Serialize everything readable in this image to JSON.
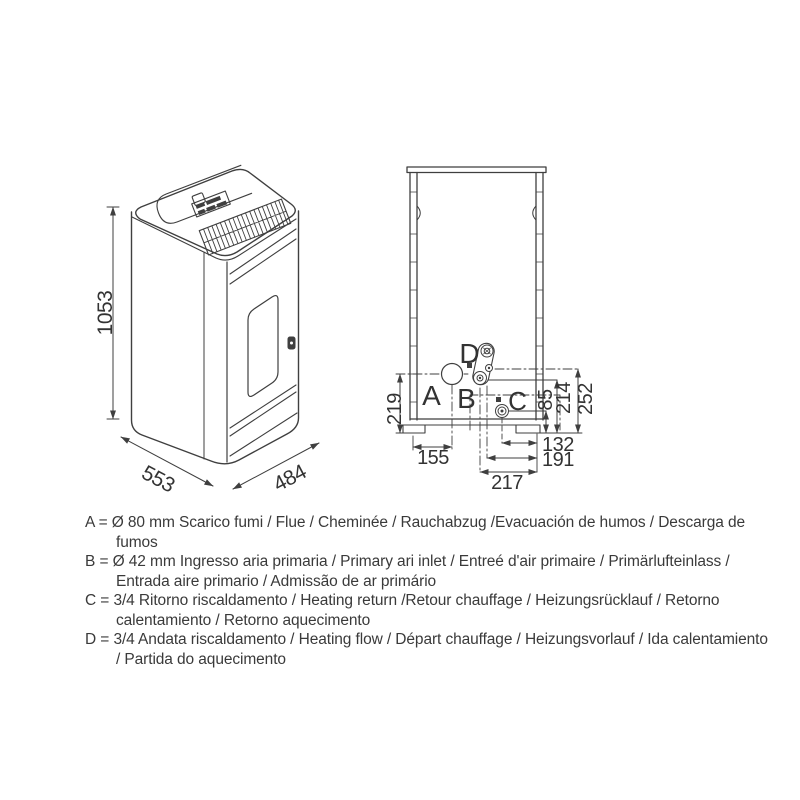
{
  "page": {
    "background": "#ffffff",
    "line_color": "#3f3f3f"
  },
  "iso_view": {
    "description": "isometric-stove-drawing",
    "dims": {
      "height": "1053",
      "depth": "553",
      "width": "484"
    }
  },
  "rear_view": {
    "description": "rear-connections-drawing",
    "labels": {
      "a": "A",
      "b": "B",
      "c": "C",
      "d": "D"
    },
    "dims": {
      "d219": "219",
      "d155": "155",
      "d85": "85",
      "d214": "214",
      "d252": "252",
      "d132": "132",
      "d191": "191",
      "d217": "217"
    }
  },
  "legend": {
    "items": [
      {
        "text": "A = Ø 80 mm Scarico fumi / Flue / Cheminée / Rauchabzug /Evacuación de humos / Descarga de fumos"
      },
      {
        "text": "B = Ø 42 mm Ingresso aria primaria / Primary ari inlet / Entreé d'air primaire / Primärlufteinlass / Entrada aire primario / Admissão de ar primário"
      },
      {
        "text": "C = 3/4  Ritorno riscaldamento / Heating return /Retour chauffage / Heizungsrücklauf / Retorno calentamiento / Retorno aquecimento"
      },
      {
        "text": "D = 3/4 Andata riscaldamento / Heating flow / Départ chauffage / Heizungsvorlauf / Ida calentamiento / Partida do aquecimento"
      }
    ]
  }
}
